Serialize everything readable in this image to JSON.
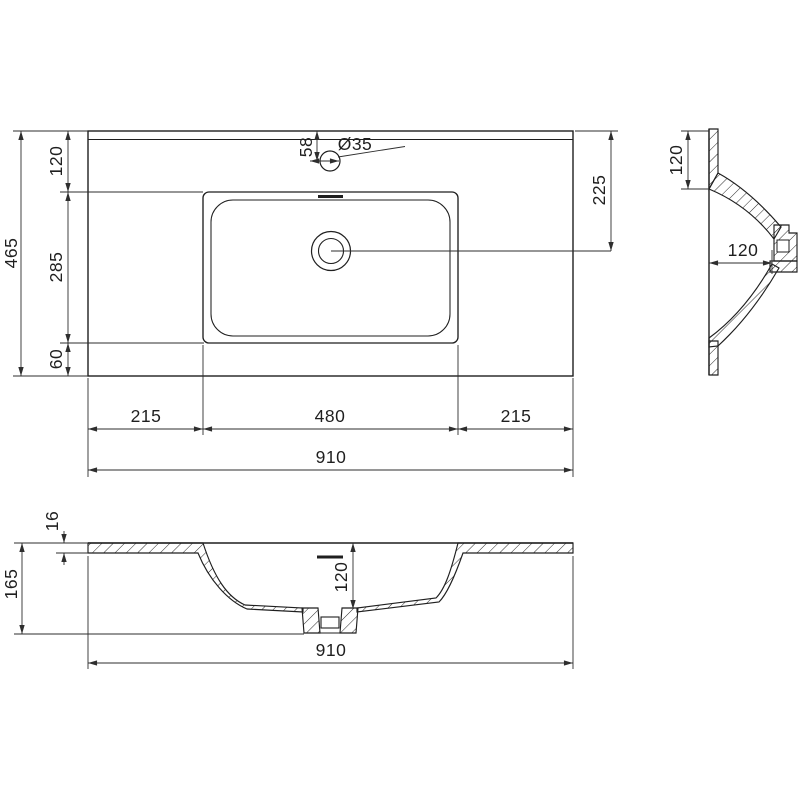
{
  "drawing": {
    "type": "technical-dimension-drawing",
    "subject": "rectangular vanity washbasin with integrated countertop",
    "background_color": "#ffffff",
    "line_color": "#1f1f1f",
    "dimension_color": "#2e2e2e",
    "units": "mm",
    "top_view": {
      "overall_width": "910",
      "overall_depth": "465",
      "edge_to_basin": "120",
      "basin_depth_span": "285",
      "basin_to_front_edge": "60",
      "left_margin": "215",
      "basin_width": "480",
      "right_margin": "215",
      "faucet_hole_diameter": "Ø35",
      "faucet_hole_offset": "58",
      "drain_center_from_back": "225"
    },
    "side_section": {
      "back_deck_depth": "120",
      "drain_inset": "120"
    },
    "front_section": {
      "top_thickness": "16",
      "overall_height": "165",
      "bowl_inner_depth": "120",
      "overall_width": "910"
    }
  }
}
